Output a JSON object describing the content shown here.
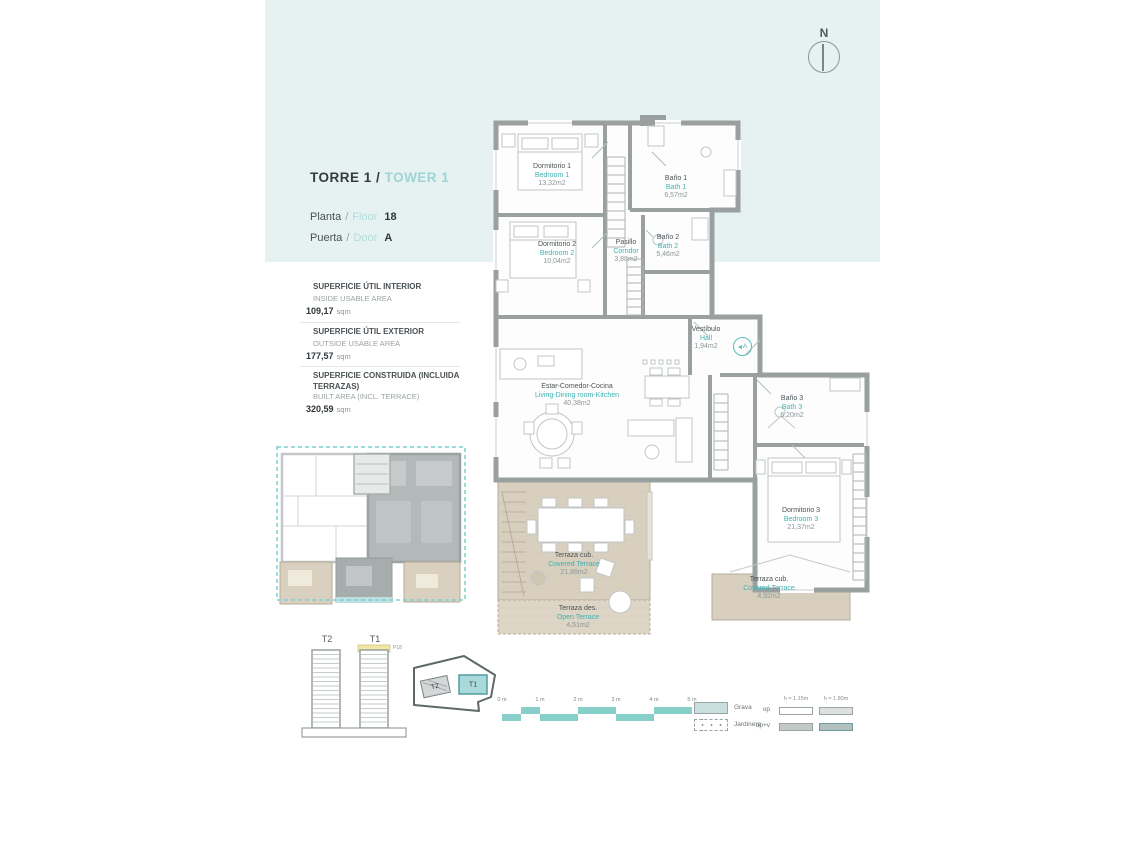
{
  "header": {
    "title_es": "TORRE 1",
    "title_sep": "/",
    "title_en": "TOWER 1",
    "planta_es": "Planta",
    "planta_sep": "/",
    "planta_en": "Floor",
    "planta_value": "18",
    "puerta_es": "Puerta",
    "puerta_sep": "/",
    "puerta_en": "Door",
    "puerta_value": "A"
  },
  "compass": {
    "label": "N"
  },
  "areas": [
    {
      "label_es": "SUPERFICIE ÚTIL INTERIOR",
      "label_en": "INSIDE USABLE AREA",
      "value": "109,17",
      "unit": "sqm"
    },
    {
      "label_es": "SUPERFICIE ÚTIL EXTERIOR",
      "label_en": "OUTSIDE USABLE AREA",
      "value": "177,57",
      "unit": "sqm"
    },
    {
      "label_es": "SUPERFICIE CONSTRUIDA (INCLUIDA TERRAZAS)",
      "label_en": "BUILT AREA (INCL. TERRACE)",
      "value": "320,59",
      "unit": "sqm"
    }
  ],
  "rooms": [
    {
      "name_es": "Dormitorio 1",
      "name_en": "Bedroom 1",
      "area": "13,32m2"
    },
    {
      "name_es": "Baño 1",
      "name_en": "Bath 1",
      "area": "6,57m2"
    },
    {
      "name_es": "Dormitorio 2",
      "name_en": "Bedroom 2",
      "area": "10,04m2"
    },
    {
      "name_es": "Pasillo",
      "name_en": "Corridor",
      "area": "3,88m2"
    },
    {
      "name_es": "Baño 2",
      "name_en": "Bath 2",
      "area": "5,46m2"
    },
    {
      "name_es": "Vestíbulo",
      "name_en": "Hall",
      "area": "1,94m2"
    },
    {
      "name_es": "Estar-Comedor-Cocina",
      "name_en": "Living-Dining room-Kitchen",
      "area": "40,38m2"
    },
    {
      "name_es": "Baño 3",
      "name_en": "Bath 3",
      "area": "6,20m2"
    },
    {
      "name_es": "Dormitorio 3",
      "name_en": "Bedroom 3",
      "area": "21,37m2"
    },
    {
      "name_es": "Terraza cub.",
      "name_en": "Covered Terrace",
      "area": "21,86m2"
    },
    {
      "name_es": "Terraza des.",
      "name_en": "Open Terrace",
      "area": "4,51m2"
    },
    {
      "name_es": "Terraza cub.",
      "name_en": "Covered Terrace",
      "area": "4,92m2"
    }
  ],
  "entrance": {
    "label": "A"
  },
  "towers": {
    "t2": "T2",
    "t1": "T1",
    "floor_tag": "P18"
  },
  "site": {
    "t2": "T2",
    "t1": "T1"
  },
  "scalebar": {
    "labels": [
      "0 m",
      "1 m",
      "2 m",
      "3 m",
      "4 m",
      "5 m"
    ]
  },
  "legend": {
    "grava": "Grava",
    "jardinera": "Jardinera",
    "op": "op",
    "opv": "op+v",
    "h1": "h = 1.15m",
    "h2": "h = 1.80m"
  },
  "colors": {
    "accent_teal": "#3eb1b3",
    "light_teal_band": "#e6f2f1",
    "terrace_tan": "#d8cfbe",
    "wall_gray": "#9aa0a0",
    "highlight_yellow": "#efe7a3"
  }
}
